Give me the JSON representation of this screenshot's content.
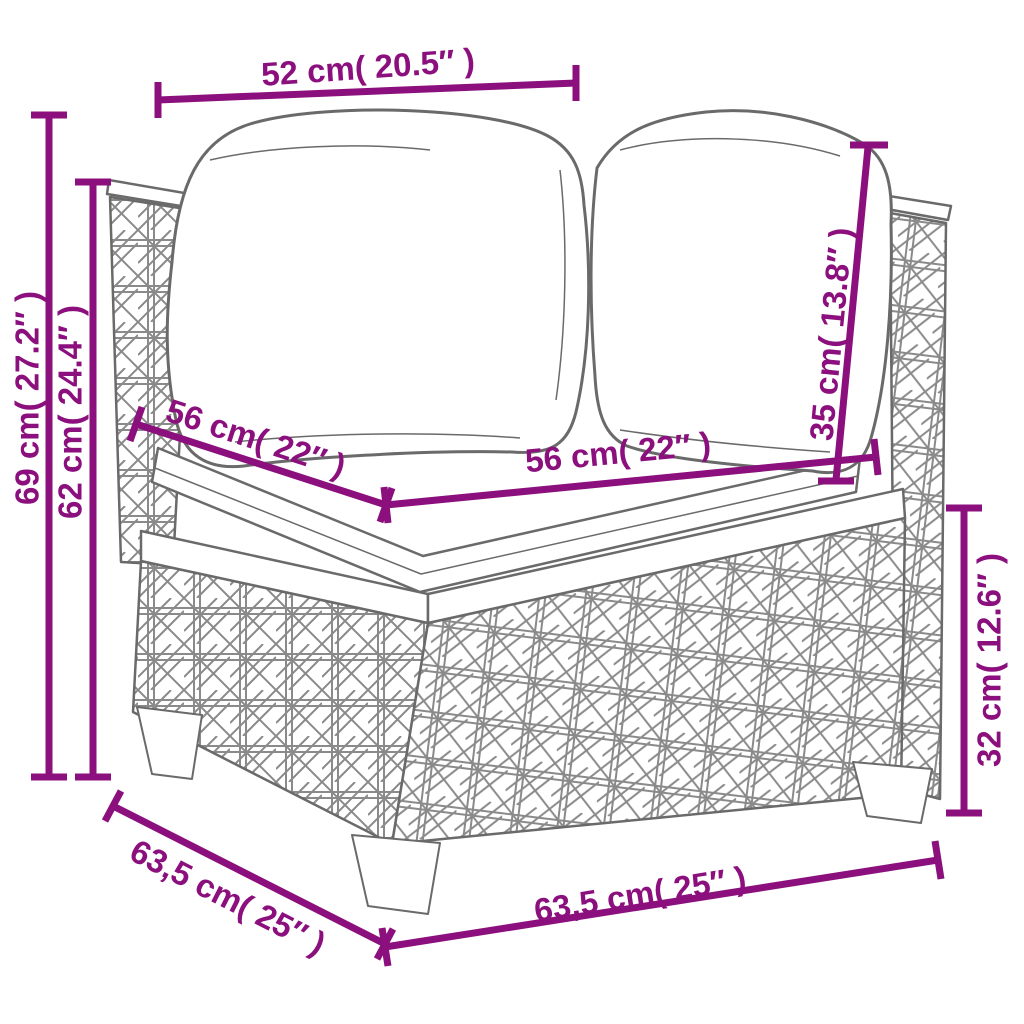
{
  "canvas": {
    "width": 1024,
    "height": 1024,
    "background": "#ffffff"
  },
  "palette": {
    "dimension_color": "#8b0f7d",
    "line_art_color": "#6a6a6a",
    "weave_color": "#8a8a8a",
    "fill_color": "#ffffff"
  },
  "diagram": {
    "subject": "poly-rattan corner sofa with two back cushions and a seat cushion",
    "dimensions": {
      "top_width": {
        "label": "52 cm( 20.5″ )",
        "value_cm": "52",
        "value_in": "20.5"
      },
      "total_height": {
        "label": "69 cm( 27.2″ )",
        "value_cm": "69",
        "value_in": "27.2"
      },
      "arm_height": {
        "label": "62 cm( 24.4″ )",
        "value_cm": "62",
        "value_in": "24.4"
      },
      "seat_depth": {
        "label": "56 cm( 22″ )",
        "value_cm": "56",
        "value_in": "22"
      },
      "seat_width": {
        "label": "56 cm( 22″ )",
        "value_cm": "56",
        "value_in": "22"
      },
      "back_cushion_height": {
        "label": "35 cm( 13.8″ )",
        "value_cm": "35",
        "value_in": "13.8"
      },
      "base_height": {
        "label": "32 cm( 12.6″ )",
        "value_cm": "32",
        "value_in": "12.6"
      },
      "depth": {
        "label": "63,5 cm( 25″ )",
        "value_cm": "63,5",
        "value_in": "25"
      },
      "width": {
        "label": "63,5 cm( 25″ )",
        "value_cm": "63,5",
        "value_in": "25"
      }
    }
  }
}
